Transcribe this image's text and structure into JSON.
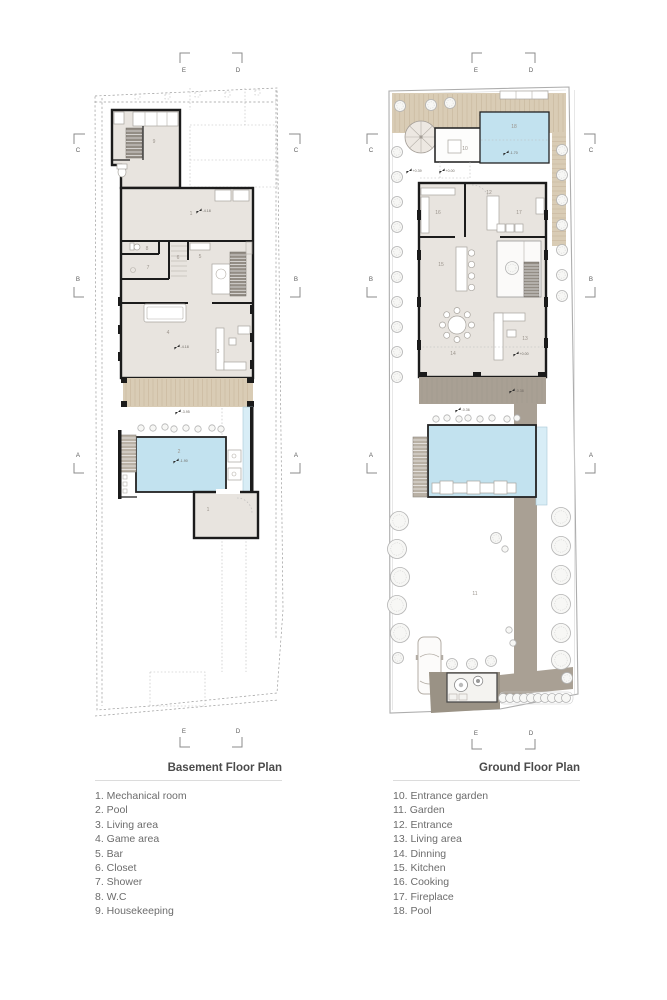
{
  "colors": {
    "wall": "#1b1b1b",
    "floor": "#e8e4df",
    "pool_blue": "#c2e2ef",
    "wood_deck": "#d9ccb5",
    "path_gray": "#a9a094",
    "boundary_dash": "#9c9c9c",
    "title_text": "#4b4b4b",
    "legend_text": "#6c6c6c"
  },
  "plans": {
    "basement": {
      "title": "Basement Floor Plan",
      "legend": [
        "1. Mechanical room",
        "2. Pool",
        "3. Living area",
        "4. Game area",
        "5. Bar",
        "6. Closet",
        "7. Shower",
        "8. W.C",
        "9. Housekeeping"
      ],
      "rooms": {
        "mechanical": "1",
        "pool": "2",
        "living": "3",
        "game": "4",
        "bar": "5",
        "closet": "6",
        "shower": "7",
        "wc": "8",
        "housekeeping": "9"
      },
      "levels": {
        "mechanical": "-4.18",
        "living": "-4.18",
        "deck": "-3.95",
        "pool": "-1.90"
      },
      "markers": {
        "top": [
          "E",
          "D"
        ],
        "bottom": [
          "E",
          "D"
        ],
        "left": [
          "C",
          "B",
          "A"
        ],
        "right": [
          "C",
          "B",
          "A"
        ]
      }
    },
    "ground": {
      "title": "Ground Floor Plan",
      "legend": [
        "10. Entrance garden",
        "11. Garden",
        "12. Entrance",
        "13. Living area",
        "14. Dinning",
        "15. Kitchen",
        "16. Cooking",
        "17. Fireplace",
        "18. Pool"
      ],
      "rooms": {
        "entrance_garden": "10",
        "garden": "11",
        "entrance": "12",
        "living": "13",
        "dinning": "14",
        "kitchen": "15",
        "cooking": "16",
        "fireplace": "17",
        "pool": "18"
      },
      "levels": {
        "front": "+0.39",
        "entrance": "+0.00",
        "pool": "-1.70",
        "living": "+0.00",
        "terrace": "-0.38",
        "pool_deck": "-0.36"
      },
      "markers": {
        "top": [
          "E",
          "D"
        ],
        "bottom": [
          "E",
          "D"
        ],
        "left": [
          "C",
          "B",
          "A"
        ],
        "right": [
          "C",
          "B",
          "A"
        ]
      }
    }
  }
}
